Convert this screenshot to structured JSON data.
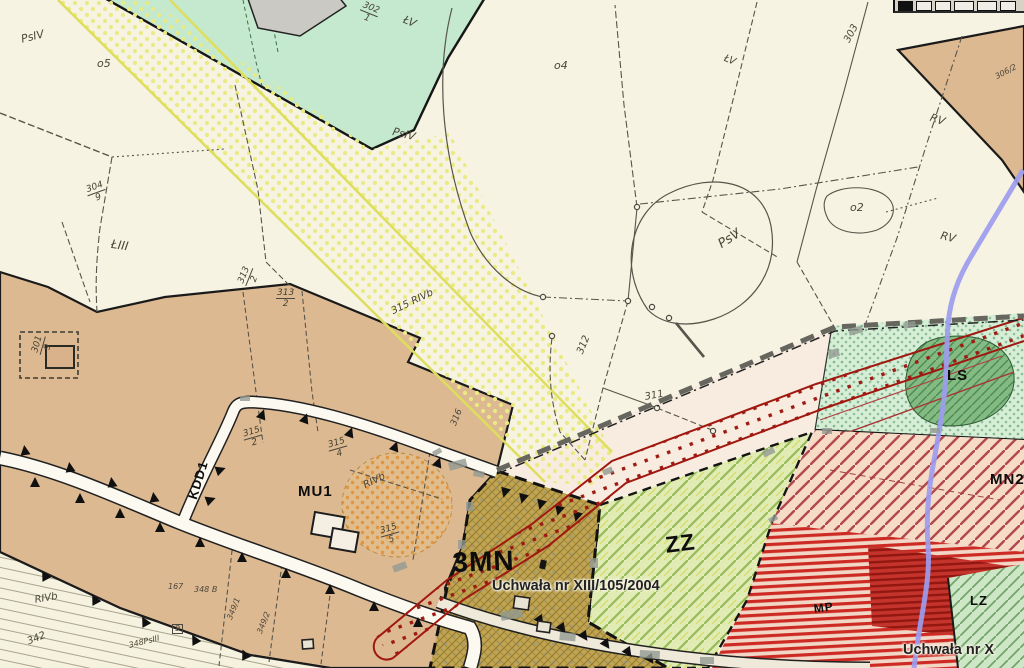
{
  "map": {
    "type": "scanned zoning plan (miejscowy plan zagospodarowania przestrzennego)",
    "labels": [
      {
        "text": "PsIV"
      },
      {
        "text": "o5"
      },
      {
        "text": "ŁV"
      },
      {
        "text": "PsIV"
      },
      {
        "text": "o4"
      },
      {
        "text": "ŁV"
      },
      {
        "text": "303"
      },
      {
        "text": "RV"
      },
      {
        "text": "o2"
      },
      {
        "text": "RV"
      },
      {
        "text": "PsV"
      },
      {
        "text": "ŁIII"
      },
      {
        "text": "312"
      },
      {
        "text": "311"
      },
      {
        "text": "316"
      },
      {
        "text": "RIVb"
      },
      {
        "text": "315 RIVb"
      },
      {
        "text": "MU1"
      },
      {
        "text": "KDD1"
      },
      {
        "text": "3MN"
      },
      {
        "text": "ZZ"
      },
      {
        "text": "Uchwała nr XIII/105/2004"
      },
      {
        "text": "LS"
      },
      {
        "text": "MN2"
      },
      {
        "text": "MP"
      },
      {
        "text": "LZ"
      },
      {
        "text": "Uchwała nr X"
      },
      {
        "text": "RIVb"
      },
      {
        "text": "342"
      },
      {
        "text": "167"
      },
      {
        "text": "348 B"
      },
      {
        "text": "349/1"
      },
      {
        "text": "349/2"
      },
      {
        "text": "348PsIII"
      },
      {
        "text": "306/2"
      },
      {
        "text": "9"
      }
    ],
    "fractions": [
      {
        "num": "302",
        "den": "1"
      },
      {
        "num": "301",
        "den": "9"
      },
      {
        "num": "304",
        "den": "9"
      },
      {
        "num": "313",
        "den": "2"
      },
      {
        "num": "313",
        "den": "2"
      },
      {
        "num": "315",
        "den": "2"
      },
      {
        "num": "315",
        "den": "4"
      },
      {
        "num": "315",
        "den": "5"
      }
    ],
    "colors": {
      "background": "#f6f3e2",
      "tan_zone": "#ddb992",
      "green_area_top": "#c4e9ce",
      "gray_parcel": "#cac9c4",
      "khaki_3mn": "#c3a453",
      "zz_green": "#e0ecb4",
      "forest_green_ls": "#83bb83",
      "pink_mn2": "#f6dcc6",
      "red_mp_stripe": "#cd2a24",
      "corridor_red": "#a01810",
      "stream_purple": "#9c9cef",
      "yellow_band": "#dede5e",
      "road_fill": "#fcfaf0",
      "titlebar_gray": "#d6d2c6"
    }
  }
}
